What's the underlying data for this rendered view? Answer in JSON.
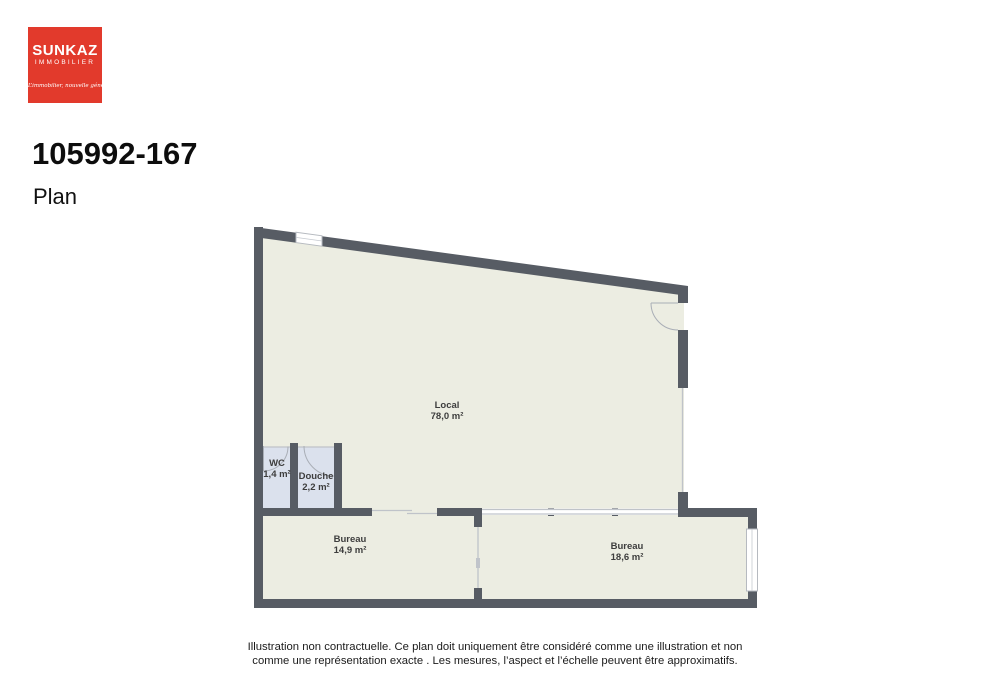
{
  "logo": {
    "brand": "SUNKAZ",
    "sector": "IMMOBILIER",
    "tagline": "L’immobilier, nouvelle génération.",
    "bg_color": "#e23a2c"
  },
  "header": {
    "reference": "105992-167",
    "subtitle": "Plan"
  },
  "plan": {
    "rooms": [
      {
        "name": "Local",
        "area": "78,0 m²"
      },
      {
        "name": "WC",
        "area": "1,4 m²"
      },
      {
        "name": "Douche",
        "area": "2,2 m²"
      },
      {
        "name": "Bureau",
        "area": "14,9 m²"
      },
      {
        "name": "Bureau",
        "area": "18,6 m²"
      }
    ],
    "colors": {
      "wall": "#575c64",
      "floor": "#ecede2",
      "wet_floor": "#dbe1ed",
      "thin_line": "#bfc3c9"
    }
  },
  "disclaimer": {
    "line1": "Illustration non contractuelle. Ce plan doit uniquement être considéré comme une illustration et non",
    "line2": "comme une représentation exacte . Les mesures, l’aspect et l’échelle peuvent être approximatifs."
  }
}
